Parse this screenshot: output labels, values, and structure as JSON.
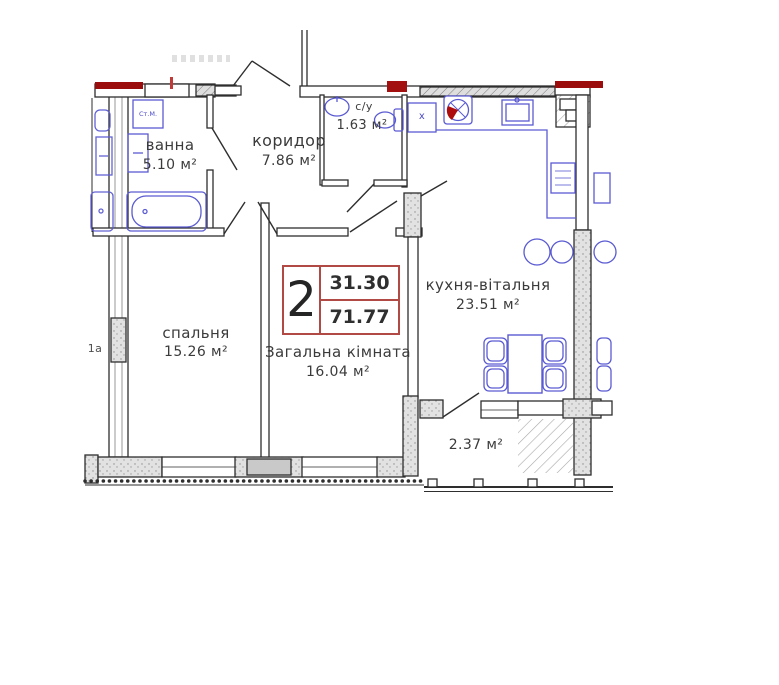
{
  "plan": {
    "card": {
      "rooms_count": "2",
      "value_top": "31.30",
      "value_bottom": "71.77"
    },
    "rooms": {
      "bathroom": {
        "name": "ванна",
        "area": "5.10 м²"
      },
      "corridor": {
        "name": "коридор",
        "area": "7.86 м²"
      },
      "wc": {
        "name": "с/у",
        "area": "1.63 м²"
      },
      "bedroom": {
        "name": "спальня",
        "area": "15.26 м²"
      },
      "living_room": {
        "name": "Загальна кімната",
        "area": "16.04 м²"
      },
      "kitchen_living": {
        "name": "кухня-вітальня",
        "area": "23.51 м²"
      },
      "balcony": {
        "area": "2.37 м²"
      }
    },
    "fixture_labels": {
      "washing_machine": "Ст.М.",
      "duct": "х",
      "neighbor_fragment": "1а"
    },
    "colors": {
      "wall": "#2e2e2e",
      "fixture": "#5a5ad2",
      "accent_red": "#9b0d0d",
      "card_border": "#b14a44",
      "text": "#3a3a3a"
    }
  }
}
